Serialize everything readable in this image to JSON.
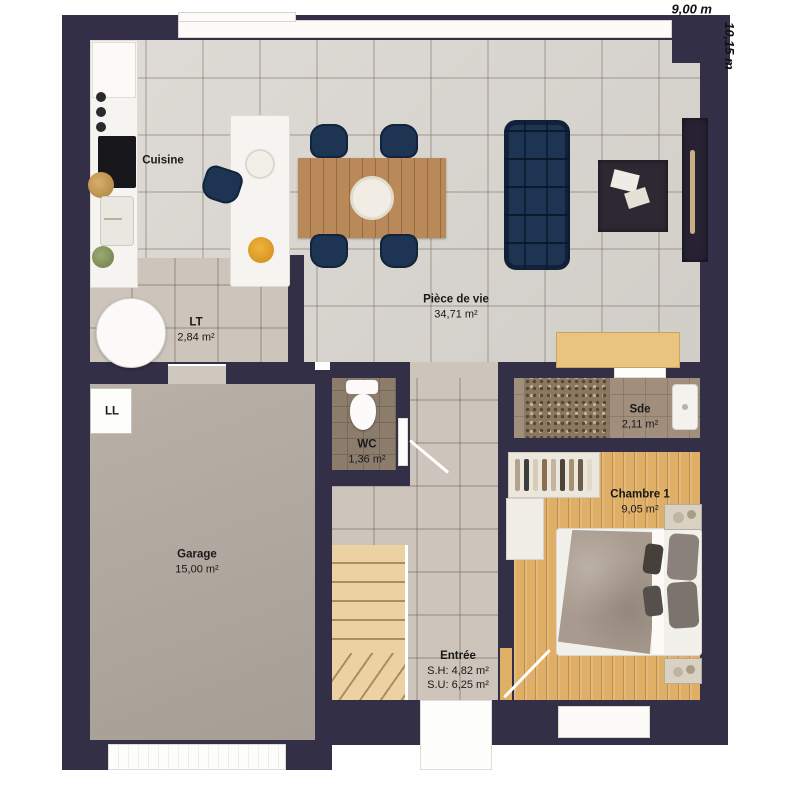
{
  "dimensions": {
    "width_label": "9,00 m",
    "height_label": "10,15 m"
  },
  "rooms": {
    "cuisine": {
      "name": "Cuisine"
    },
    "piece_de_vie": {
      "name": "Pièce de vie",
      "area": "34,71 m²"
    },
    "lt": {
      "name": "LT",
      "area": "2,84 m²"
    },
    "wc": {
      "name": "WC",
      "area": "1,36 m²"
    },
    "sde": {
      "name": "Sde",
      "area": "2,11 m²"
    },
    "chambre1": {
      "name": "Chambre 1",
      "area": "9,05 m²"
    },
    "garage": {
      "name": "Garage",
      "area": "15,00 m²"
    },
    "entree": {
      "name": "Entrée",
      "sh": "S.H: 4,82 m²",
      "su": "S.U: 6,25 m²"
    }
  },
  "appliances": {
    "washing_machine_label": "LL"
  },
  "palette": {
    "wall": "#322f46",
    "tile_living": "#d8d4ce",
    "tile_hall": "#cdc5bb",
    "garage_floor": "#b1a89e",
    "wc_floor": "#8b7c6b",
    "sde_floor": "#a08f7c",
    "wood_floor": "#dfae67",
    "stair_wood": "#ecd2a2",
    "accent_navy": "#1d3453",
    "table_wood": "#b9895a"
  }
}
